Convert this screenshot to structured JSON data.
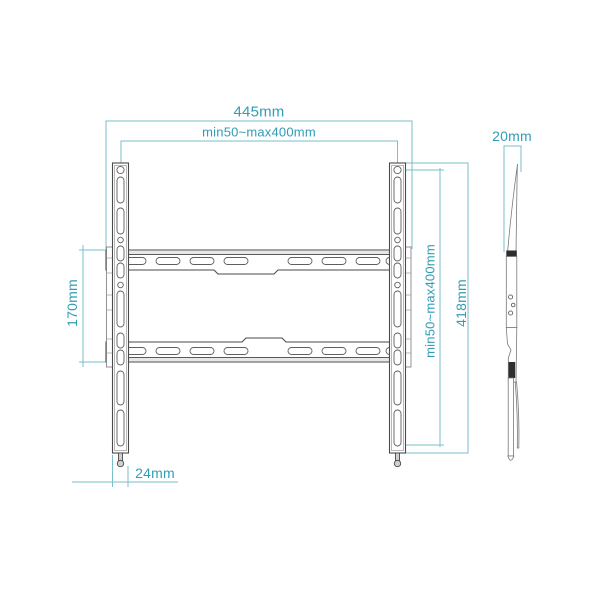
{
  "diagram": {
    "dimensions": {
      "overall_width": "445mm",
      "vesa_width": "min50~max400mm",
      "rail_span": "170mm",
      "vesa_height": "min50~max400mm",
      "overall_height": "418mm",
      "profile_depth": "20mm",
      "foot_offset": "24mm"
    },
    "colors": {
      "dimension_text": "#2f9db5",
      "dimension_line": "#79bfcd",
      "outline": "#4a4a4a"
    }
  }
}
